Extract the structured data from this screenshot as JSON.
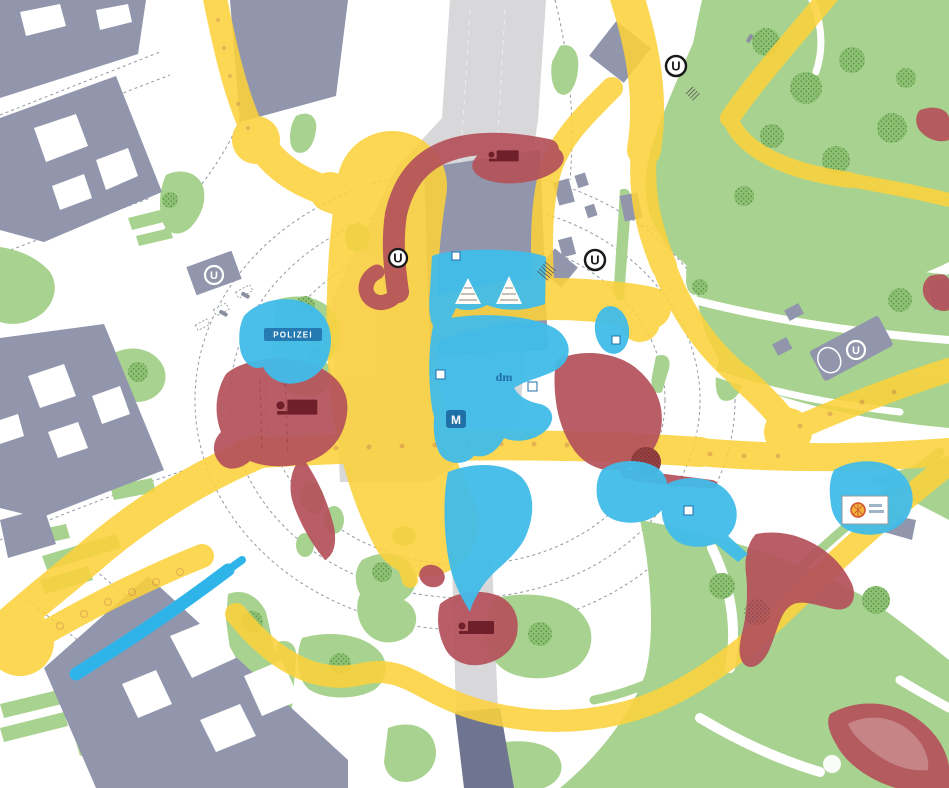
{
  "map": {
    "labels": {
      "u_marker": "U",
      "police": "POLIZEI",
      "drugstore": "dm",
      "fast_food_m": "M"
    },
    "colors": {
      "building": "#9196ac",
      "building_dark": "#6f7590",
      "rail_corridor": "#d8d7d9",
      "lawn_green": "#a8d28f",
      "tree_green": "#8cc172",
      "tree_stipple": "#3f6d33",
      "flow_yellow": "#fcd23c",
      "flow_dot": "#e3a93c",
      "zone_red": "#b4525b",
      "zone_red_dark": "#8f3540",
      "icon_maroon": "#6e1f2a",
      "zone_blue": "#41bce9",
      "zone_blue_dark": "#1f6fa8",
      "water_blue": "#2fb4e9",
      "street_line": "#9299a4",
      "marker_black": "#1a1a1a"
    }
  }
}
